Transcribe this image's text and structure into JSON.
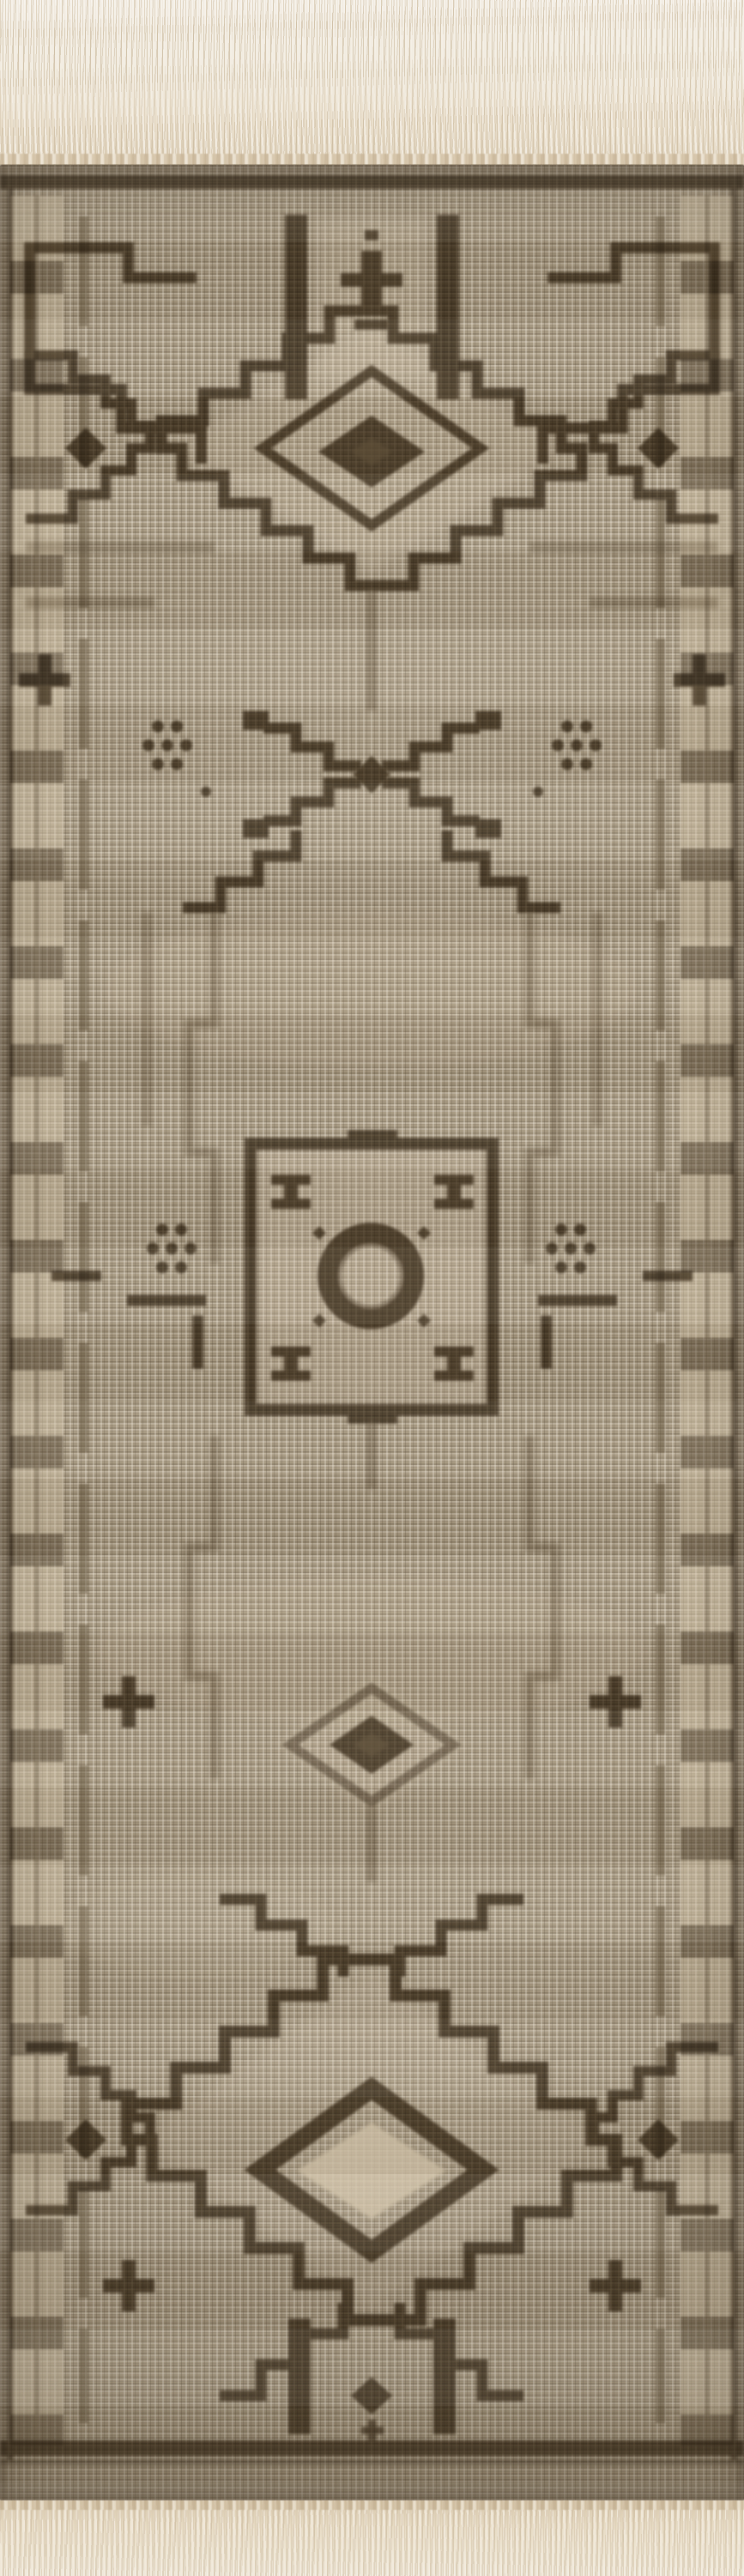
{
  "image": {
    "type": "photograph",
    "alt": "Overhead photograph of a hand-knotted wool runner rug in taupe and warm brown. Cream warp fringe hangs at the top and bottom edges. The field is a flat-woven taupe weave decorated with dark umber geometric motifs: a stepped lozenge medallion with a dark diamond core near the top, a stepped X motif with small dot rosettes, a central square medallion enclosing a thick ring with blocks in its corners, a small stepped diamond, and a large stepped lozenge medallion with a light diamond core near the bottom, all framed by dark edge bands and a chain of light blocks along the sides.",
    "subject": "hand-knotted wool runner rug",
    "pattern_style": "tribal geometric, stepped medallions",
    "orientation": "vertical runner"
  },
  "palette": {
    "backdrop": "#f5f2ec",
    "fringe_light": "#f1ebdf",
    "fringe_shadow": "#d8c8ad",
    "field": "#a5977f",
    "knot_light": "#cfc2ad",
    "weave_shadow": "#6e5f48",
    "pattern_dark": "#5a4b35",
    "pattern_mid": "#7d6d53",
    "core_light": "#dbcdb4"
  },
  "elements": {
    "fringe_top": "knotted warp fringe",
    "fringe_bottom": "knotted warp fringe",
    "border": "dark edge bands with block-chain guard stripe",
    "castle_motif": "stepped gate motif with twin vertical bars",
    "top_medallion": "stepped lozenge medallion with dark diamond core",
    "cross_motif": "stepped X motif with dot rosettes",
    "center_medallion": "square medallion with ring center and corner blocks",
    "small_diamond": "small stepped diamond motif",
    "bottom_medallion": "stepped lozenge medallion with light diamond core",
    "accents": "stepped crosses and dot rosettes along the borders"
  }
}
